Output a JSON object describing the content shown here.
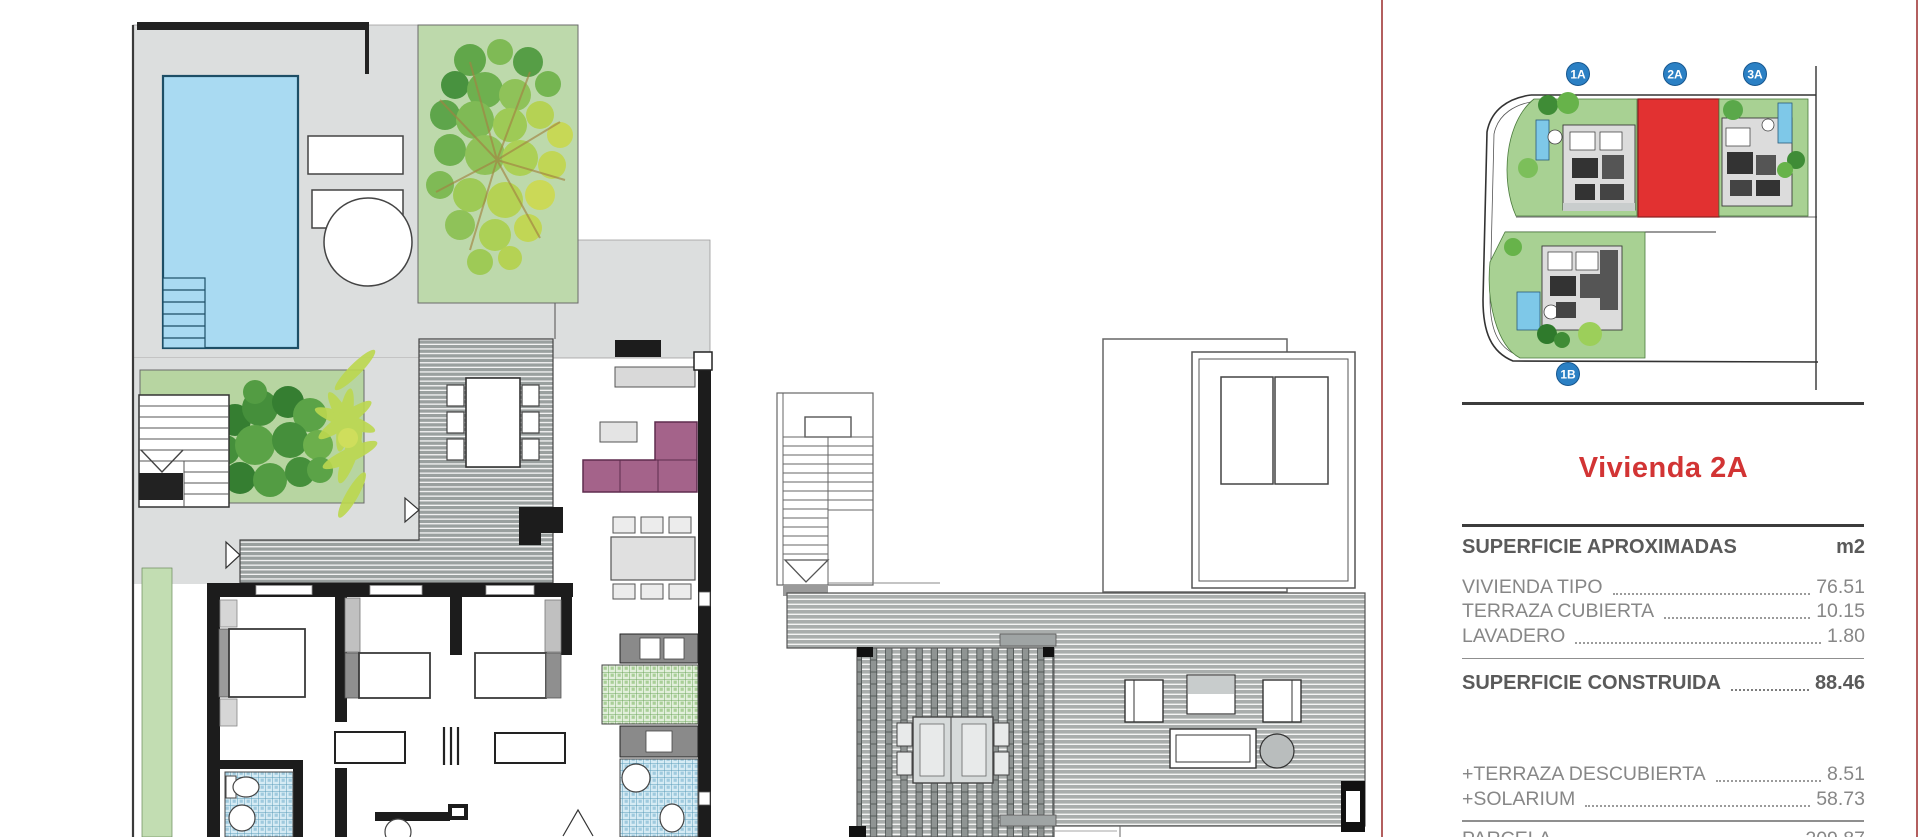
{
  "panel": {
    "title": "Vivienda 2A",
    "header": {
      "label": "SUPERFICIE APROXIMADAS",
      "unit": "m2"
    },
    "rows": [
      {
        "label": "VIVIENDA TIPO",
        "value": "76.51"
      },
      {
        "label": "TERRAZA CUBIERTA",
        "value": "10.15"
      },
      {
        "label": "LAVADERO",
        "value": "1.80"
      }
    ],
    "total": {
      "label": "SUPERFICIE CONSTRUIDA",
      "value": "88.46"
    },
    "extras": [
      {
        "label": "+TERRAZA DESCUBIERTA",
        "value": "8.51"
      },
      {
        "label": "+SOLARIUM",
        "value": "58.73"
      }
    ],
    "parcela": {
      "label": "PARCELA",
      "value": "209.87"
    }
  },
  "site_plan": {
    "badges": [
      {
        "id": "1A",
        "highlighted": false
      },
      {
        "id": "2A",
        "highlighted": true
      },
      {
        "id": "3A",
        "highlighted": false
      },
      {
        "id": "1B",
        "highlighted": false
      }
    ],
    "highlight_color": "#e23131",
    "badge_color": "#2b80c4"
  },
  "colors": {
    "title_red": "#d23434",
    "panel_border": "#b35f5f",
    "pool_blue": "#a9daf2",
    "garden_green": "#bdd9ab",
    "deck_gray": "#9aa09f",
    "sofa_purple": "#a4638a"
  }
}
